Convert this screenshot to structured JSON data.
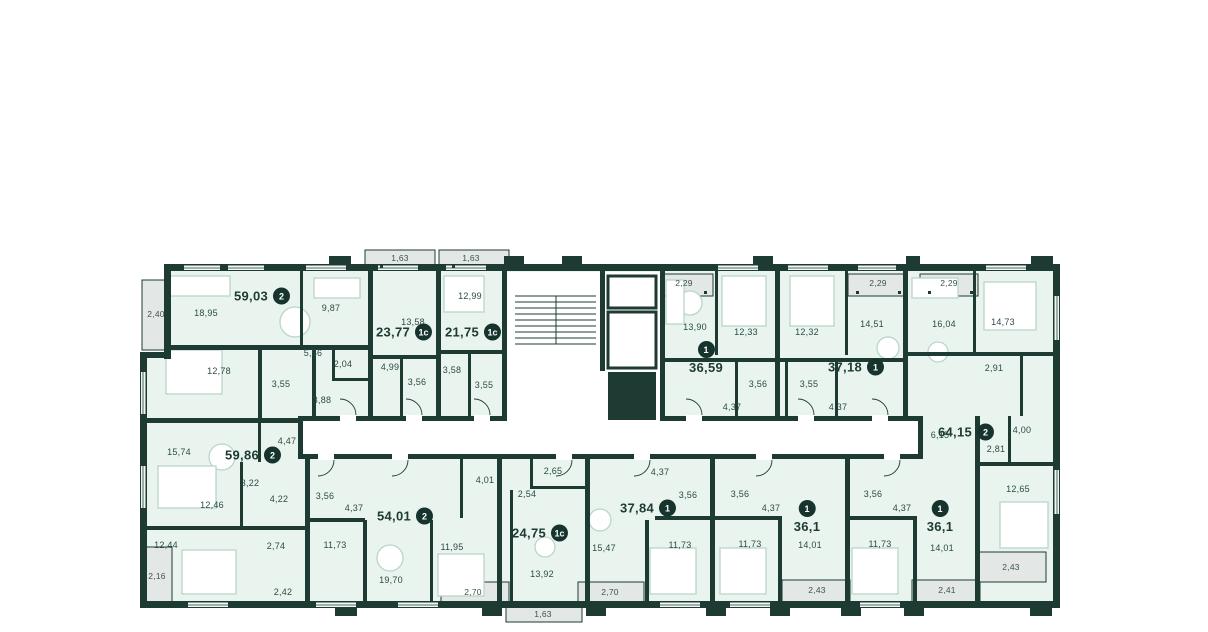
{
  "colors": {
    "wall": "#1e3b33",
    "room_fill": "#e9f4ee",
    "balcony_fill": "#e3e7e5",
    "corridor_fill": "#ffffff",
    "badge_bg": "#16342d",
    "badge_text": "#ffffff",
    "label_text": "#2b4c44",
    "furniture_line": "#b9d5c9"
  },
  "apartments": [
    {
      "area": "59,03",
      "type": "2",
      "x": 262,
      "y": 296,
      "layout": "row"
    },
    {
      "area": "23,77",
      "type": "1с",
      "x": 404,
      "y": 332,
      "layout": "row"
    },
    {
      "area": "21,75",
      "type": "1с",
      "x": 473,
      "y": 332,
      "layout": "row"
    },
    {
      "area": "36,59",
      "type": "1",
      "x": 706,
      "y": 358,
      "layout": "stack"
    },
    {
      "area": "37,18",
      "type": "1",
      "x": 856,
      "y": 367,
      "layout": "row"
    },
    {
      "area": "64,15",
      "type": "2",
      "x": 966,
      "y": 432,
      "layout": "row"
    },
    {
      "area": "59,86",
      "type": "2",
      "x": 253,
      "y": 455,
      "layout": "row"
    },
    {
      "area": "54,01",
      "type": "2",
      "x": 405,
      "y": 516,
      "layout": "row"
    },
    {
      "area": "24,75",
      "type": "1с",
      "x": 540,
      "y": 533,
      "layout": "row"
    },
    {
      "area": "37,84",
      "type": "1",
      "x": 648,
      "y": 508,
      "layout": "row"
    },
    {
      "area": "36,1",
      "type": "1",
      "x": 807,
      "y": 517,
      "layout": "stack"
    },
    {
      "area": "36,1",
      "type": "1",
      "x": 940,
      "y": 517,
      "layout": "stack"
    }
  ],
  "room_labels": [
    {
      "text": "18,95",
      "x": 206,
      "y": 313
    },
    {
      "text": "9,87",
      "x": 331,
      "y": 308
    },
    {
      "text": "5,56",
      "x": 313,
      "y": 353
    },
    {
      "text": "2,04",
      "x": 343,
      "y": 364
    },
    {
      "text": "12,78",
      "x": 219,
      "y": 371
    },
    {
      "text": "3,55",
      "x": 281,
      "y": 384
    },
    {
      "text": "3,88",
      "x": 322,
      "y": 400
    },
    {
      "text": "13,58",
      "x": 413,
      "y": 322
    },
    {
      "text": "4,99",
      "x": 390,
      "y": 367
    },
    {
      "text": "3,56",
      "x": 417,
      "y": 382
    },
    {
      "text": "12,99",
      "x": 470,
      "y": 296
    },
    {
      "text": "3,58",
      "x": 452,
      "y": 370
    },
    {
      "text": "3,55",
      "x": 484,
      "y": 385
    },
    {
      "text": "13,90",
      "x": 695,
      "y": 327
    },
    {
      "text": "12,33",
      "x": 746,
      "y": 332
    },
    {
      "text": "3,56",
      "x": 758,
      "y": 384
    },
    {
      "text": "4,37",
      "x": 732,
      "y": 407
    },
    {
      "text": "12,32",
      "x": 807,
      "y": 332
    },
    {
      "text": "14,51",
      "x": 872,
      "y": 324
    },
    {
      "text": "3,55",
      "x": 809,
      "y": 384
    },
    {
      "text": "4,37",
      "x": 838,
      "y": 407
    },
    {
      "text": "16,04",
      "x": 944,
      "y": 324
    },
    {
      "text": "14,73",
      "x": 1003,
      "y": 322
    },
    {
      "text": "2,91",
      "x": 994,
      "y": 368
    },
    {
      "text": "4,00",
      "x": 1022,
      "y": 430
    },
    {
      "text": "6,15",
      "x": 940,
      "y": 435
    },
    {
      "text": "2,81",
      "x": 996,
      "y": 449
    },
    {
      "text": "12,65",
      "x": 1018,
      "y": 489
    },
    {
      "text": "15,74",
      "x": 179,
      "y": 452
    },
    {
      "text": "4,47",
      "x": 287,
      "y": 441
    },
    {
      "text": "3,22",
      "x": 250,
      "y": 483
    },
    {
      "text": "4,22",
      "x": 279,
      "y": 499
    },
    {
      "text": "12,46",
      "x": 212,
      "y": 505
    },
    {
      "text": "2,74",
      "x": 276,
      "y": 546
    },
    {
      "text": "12,44",
      "x": 166,
      "y": 545
    },
    {
      "text": "2,42",
      "x": 283,
      "y": 592
    },
    {
      "text": "3,56",
      "x": 325,
      "y": 496
    },
    {
      "text": "4,37",
      "x": 354,
      "y": 508
    },
    {
      "text": "11,73",
      "x": 335,
      "y": 545
    },
    {
      "text": "11,95",
      "x": 452,
      "y": 547
    },
    {
      "text": "19,70",
      "x": 391,
      "y": 580
    },
    {
      "text": "4,01",
      "x": 485,
      "y": 480
    },
    {
      "text": "2,65",
      "x": 553,
      "y": 471
    },
    {
      "text": "2,54",
      "x": 527,
      "y": 494
    },
    {
      "text": "13,92",
      "x": 542,
      "y": 574
    },
    {
      "text": "4,37",
      "x": 660,
      "y": 472
    },
    {
      "text": "3,56",
      "x": 688,
      "y": 495
    },
    {
      "text": "15,47",
      "x": 604,
      "y": 548
    },
    {
      "text": "11,73",
      "x": 680,
      "y": 545
    },
    {
      "text": "3,56",
      "x": 740,
      "y": 494
    },
    {
      "text": "4,37",
      "x": 771,
      "y": 508
    },
    {
      "text": "11,73",
      "x": 750,
      "y": 544
    },
    {
      "text": "14,01",
      "x": 810,
      "y": 545
    },
    {
      "text": "3,56",
      "x": 873,
      "y": 494
    },
    {
      "text": "4,37",
      "x": 902,
      "y": 508
    },
    {
      "text": "11,73",
      "x": 880,
      "y": 544
    },
    {
      "text": "14,01",
      "x": 942,
      "y": 548
    }
  ],
  "balcony_labels": [
    {
      "text": "1,63",
      "x": 400,
      "y": 258
    },
    {
      "text": "1,63",
      "x": 471,
      "y": 258
    },
    {
      "text": "2,29",
      "x": 684,
      "y": 283
    },
    {
      "text": "2,29",
      "x": 878,
      "y": 283
    },
    {
      "text": "2,29",
      "x": 949,
      "y": 283
    },
    {
      "text": "2,40",
      "x": 156,
      "y": 314
    },
    {
      "text": "2,16",
      "x": 157,
      "y": 576
    },
    {
      "text": "2,70",
      "x": 473,
      "y": 592
    },
    {
      "text": "1,63",
      "x": 543,
      "y": 614
    },
    {
      "text": "2,70",
      "x": 610,
      "y": 592
    },
    {
      "text": "2,43",
      "x": 817,
      "y": 590
    },
    {
      "text": "2,41",
      "x": 947,
      "y": 590
    },
    {
      "text": "2,43",
      "x": 1011,
      "y": 567
    }
  ]
}
